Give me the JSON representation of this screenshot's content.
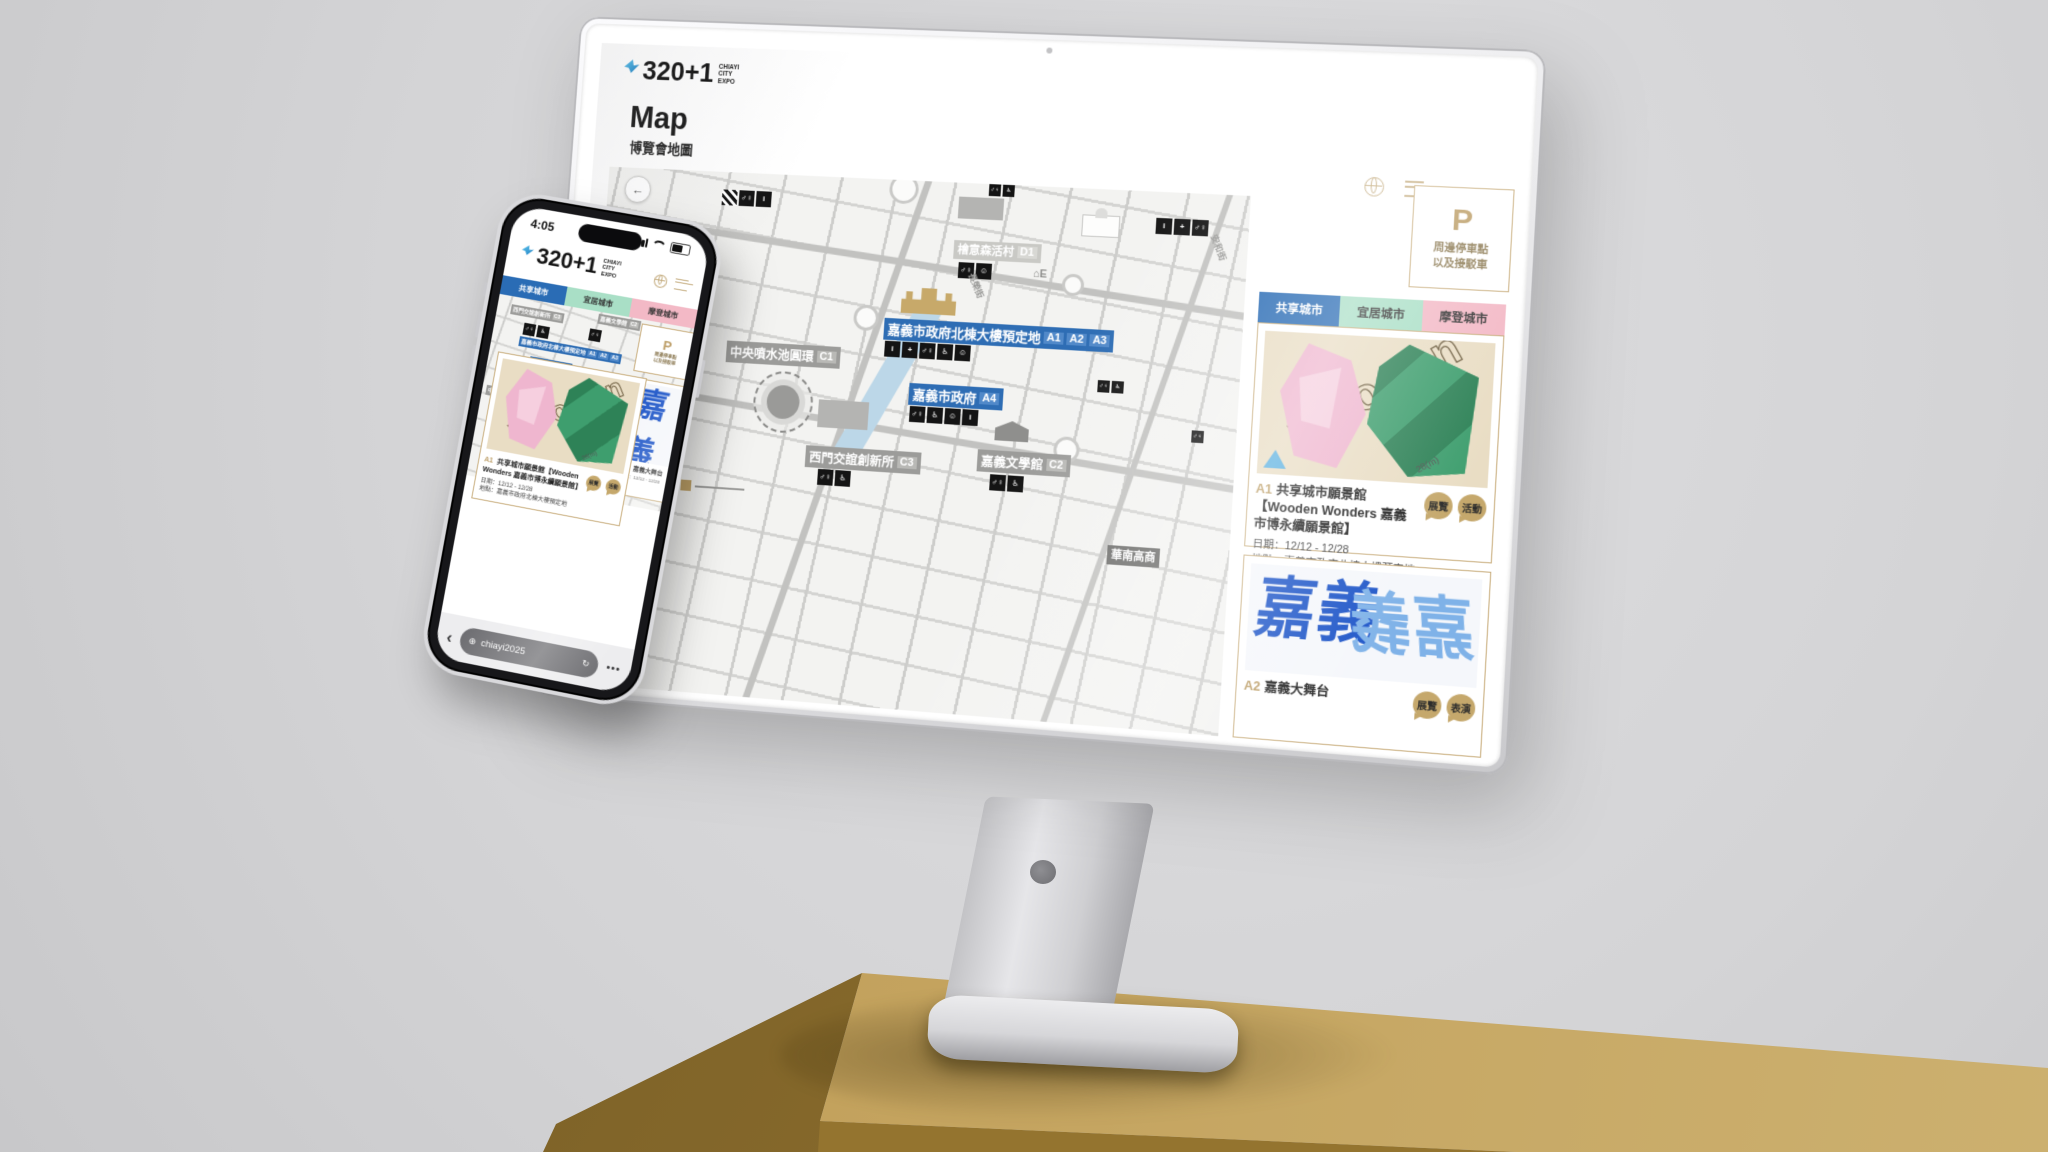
{
  "colors": {
    "accent_blue": "#2e6db4",
    "tab_blue": "#2a6cb5",
    "tab_mint": "#a9dfc6",
    "tab_pink": "#f3b9c6",
    "gold": "#bb9c64",
    "card_border": "#c9ae7e",
    "table_gold": "#c3a25d",
    "background": "#d4d4d6",
    "poster_blue": "#1d55c8",
    "wooden_green": "#3e9e6e",
    "wooden_pink": "#efb6cf"
  },
  "brand": {
    "name": "320+1",
    "tagline": [
      "CHIAYI",
      "CITY",
      "EXPO"
    ]
  },
  "desktop": {
    "title": "Map",
    "subtitle": "博覽會地圖",
    "tabs": [
      {
        "label": "共享城市",
        "color": "#2a6cb5",
        "active": true
      },
      {
        "label": "宜居城市",
        "color": "#a9dfc6",
        "active": false
      },
      {
        "label": "摩登城市",
        "color": "#f3b9c6",
        "active": false
      }
    ],
    "parking": {
      "symbol": "P",
      "lines": [
        "周邊停車點",
        "以及接駁車"
      ]
    },
    "map": {
      "back_glyph": "←",
      "station_label": "⌂E",
      "streets": [
        "民權路",
        "安和街",
        "長榮街"
      ],
      "labels": [
        {
          "text": "嘉義市政府北棟大樓預定地",
          "badges": [
            "A1",
            "A2",
            "A3"
          ],
          "style": "blue"
        },
        {
          "text": "嘉義市政府",
          "badges": [
            "A4"
          ],
          "style": "blue"
        },
        {
          "text": "中央噴水池圓環",
          "badges": [
            "C1"
          ],
          "style": "gray"
        },
        {
          "text": "西門交誼創新所",
          "badges": [
            "C3"
          ],
          "style": "gray"
        },
        {
          "text": "嘉義文學館",
          "badges": [
            "C2"
          ],
          "style": "gray"
        },
        {
          "text": "檜意森活村",
          "badges": [
            "D1"
          ],
          "style": "faded"
        },
        {
          "text": "華南高商",
          "badges": [],
          "style": "dark"
        }
      ]
    },
    "cards": [
      {
        "code": "A1",
        "name": "共享城市願景館",
        "full": "【Wooden Wonders 嘉義市博永續願景館】",
        "badges": [
          "展覽",
          "活動"
        ],
        "date_label": "日期：",
        "date": "12/12 - 12/28",
        "place_label": "地點：",
        "place": "嘉義市政府北棟大樓預定地",
        "image_word": "wooden",
        "image_note": "28(m)"
      },
      {
        "code": "A2",
        "name": "嘉義大舞台",
        "badges": [
          "展覽",
          "表演"
        ],
        "image_word": "嘉義"
      }
    ]
  },
  "phone": {
    "status_time": "4:05",
    "url": "chiayi2025",
    "back_glyph": "‹",
    "reload_glyph": "↻",
    "more_glyph": "•••",
    "globe_glyph": "⊕"
  },
  "icon_glyphs": {
    "info": "i",
    "firstaid": "+",
    "restroom": "♂♀",
    "wheelchair": "♿",
    "baby": "☺"
  }
}
